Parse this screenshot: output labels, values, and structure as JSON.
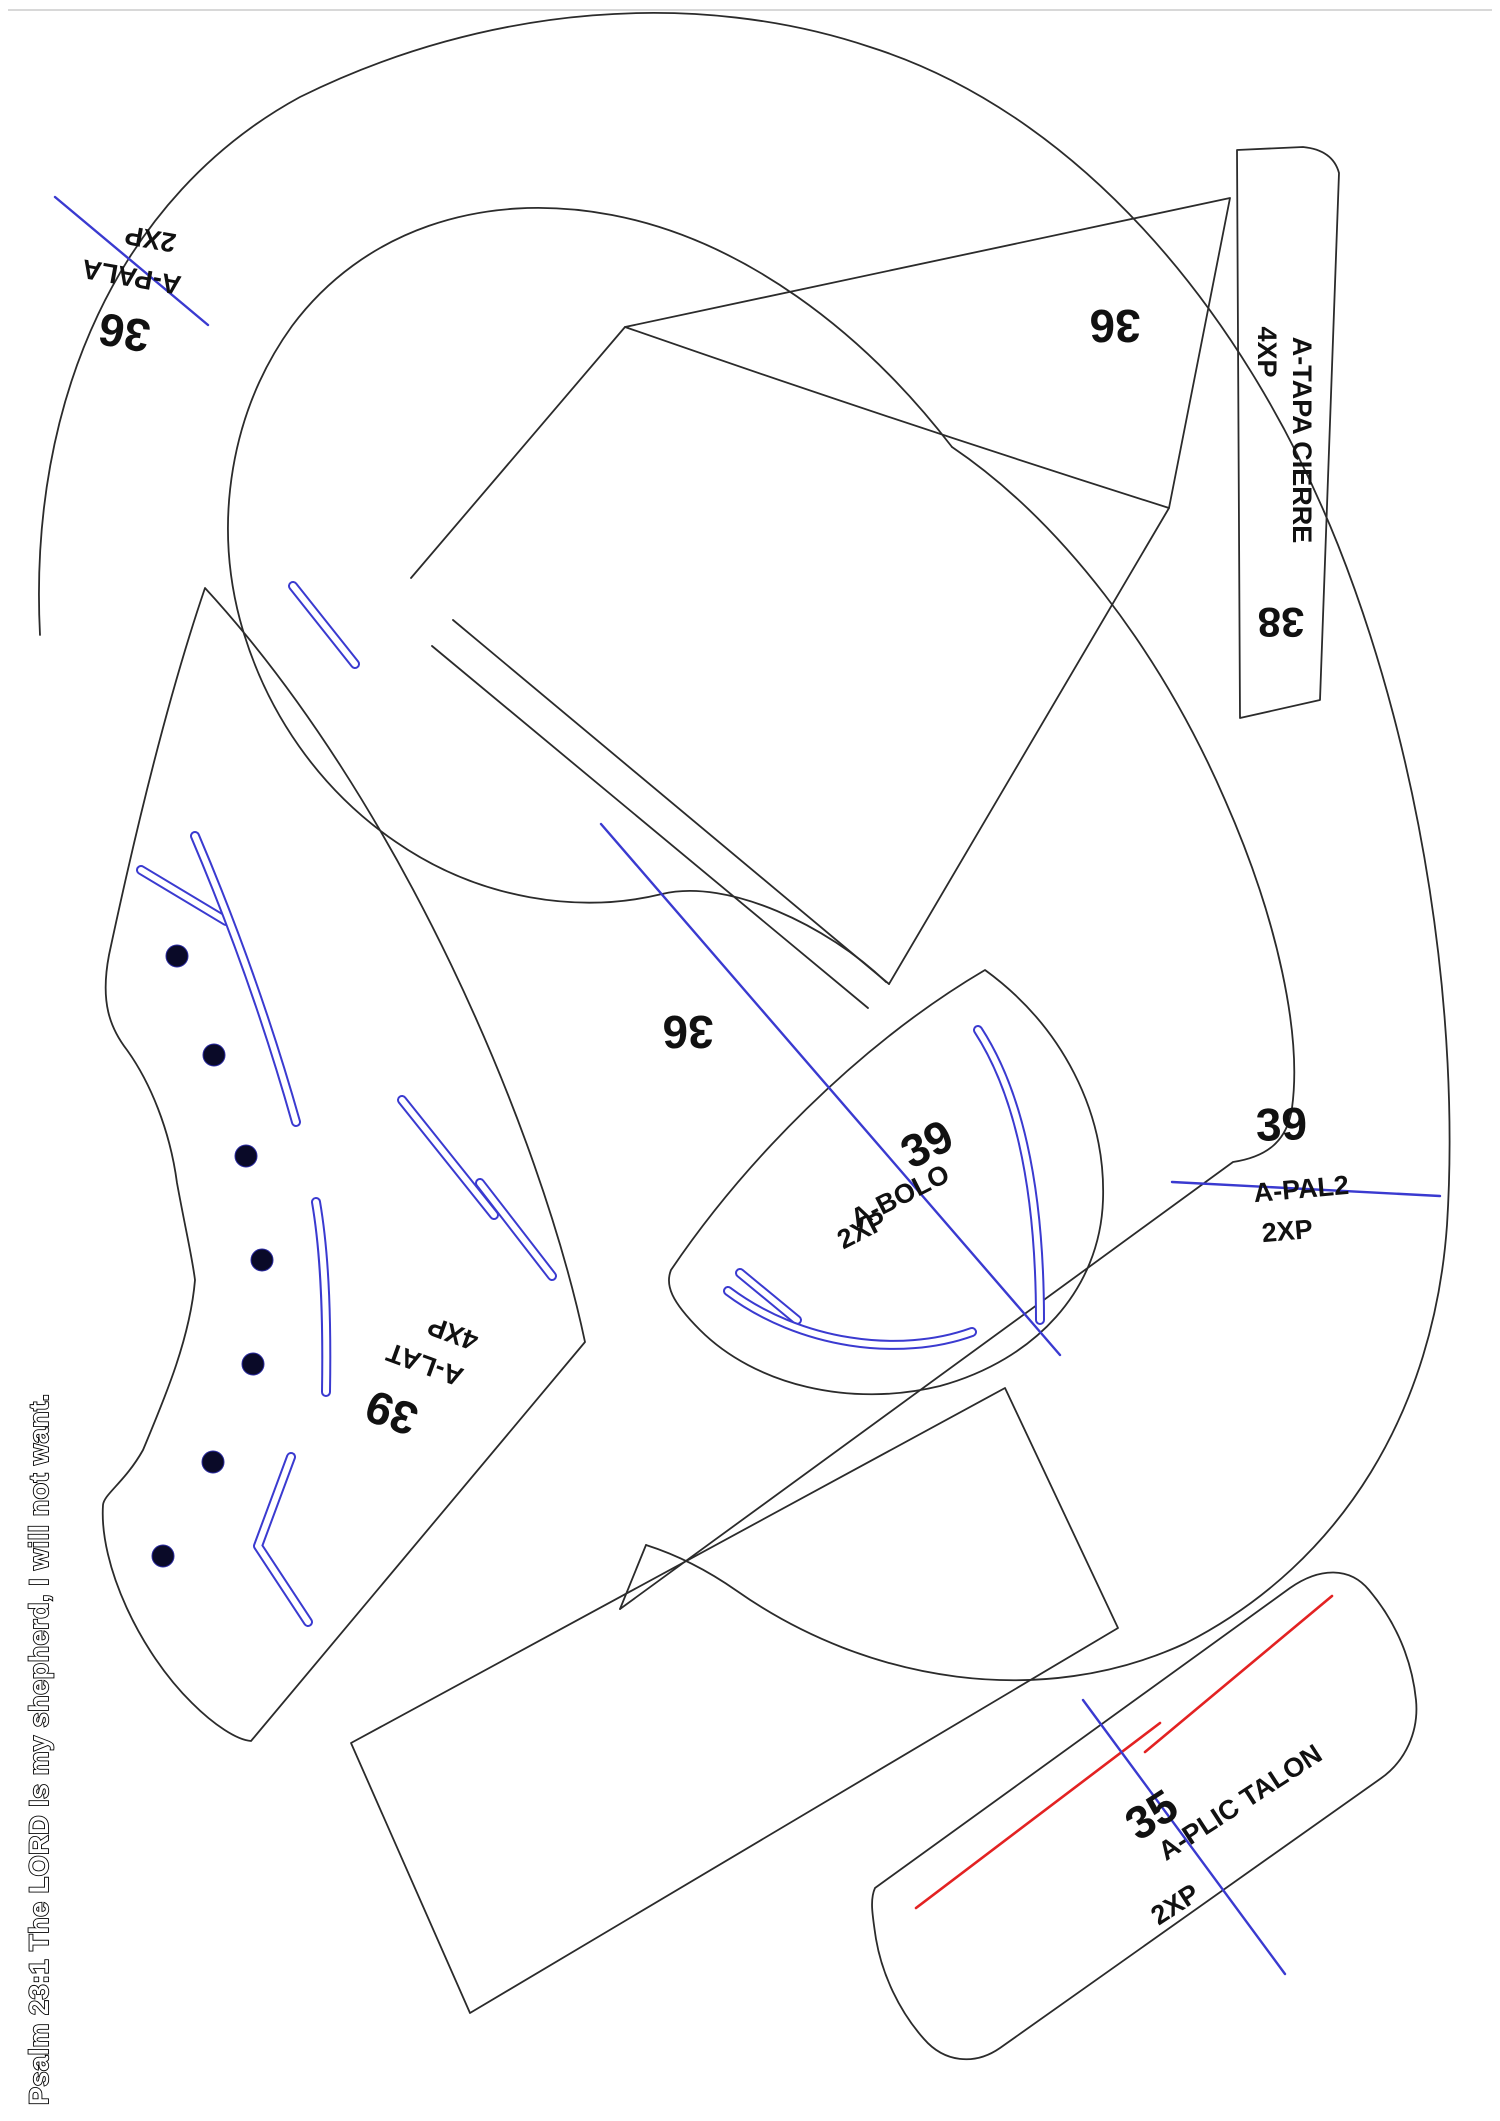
{
  "footer_text": "Psalm 23:1 The LORD Is my shepherd, I will not want.",
  "colors": {
    "line": "#2b2b2b",
    "guide_blue": "#3a3ad0",
    "guide_red": "#e32222",
    "hole_fill": "#0a0a28",
    "background": "#ffffff"
  },
  "pieces": {
    "a_pala": {
      "size": "36",
      "name": "A-PALA",
      "qty": "2XP"
    },
    "top_panel": {
      "size": "36"
    },
    "mid_panel": {
      "size": "36"
    },
    "a_tapa_cierre": {
      "size": "38",
      "name": "A-TAPA CIERRE",
      "qty": "4XP"
    },
    "a_bolo": {
      "size": "39",
      "name": "A-BOLO",
      "qty": "2XP"
    },
    "a_pal2": {
      "size": "39",
      "name": "A-PAL2",
      "qty": "2XP"
    },
    "a_lat": {
      "size": "39",
      "name": "A-LAT",
      "qty": "4XP"
    },
    "a_plic_talon": {
      "size": "35",
      "name": "A-PLIC TALON",
      "qty": "2XP"
    }
  }
}
